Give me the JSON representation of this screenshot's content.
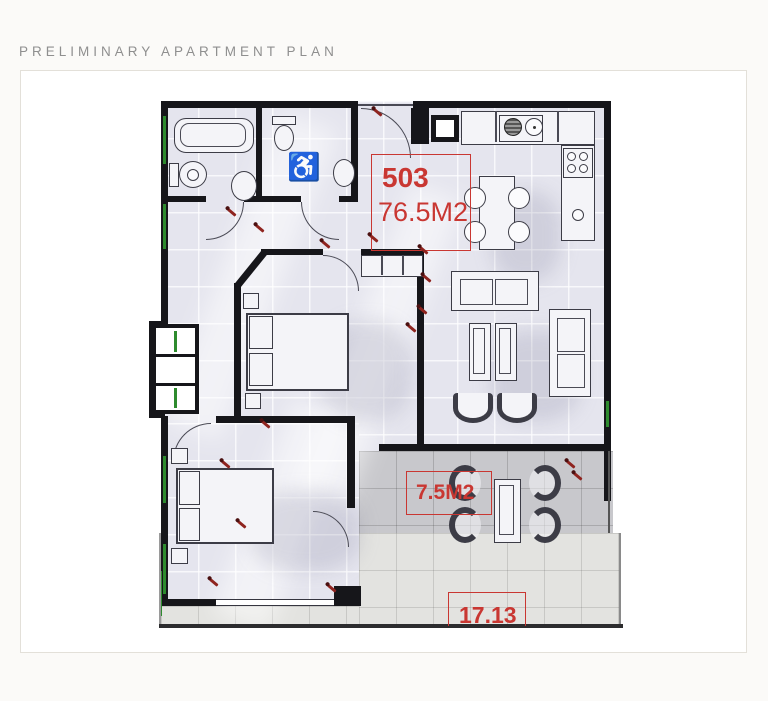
{
  "page": {
    "title": "PRELIMINARY APARTMENT PLAN"
  },
  "plan": {
    "unit": {
      "number": "503",
      "area": "76.5M2"
    },
    "balcony": {
      "area": "7.5M2"
    },
    "terrace": {
      "length": "17.13"
    },
    "accessible_symbol": "♿",
    "colors": {
      "label_red": "#c93732",
      "wall_black": "#16161a",
      "floor_lavender": "#e5e5ee",
      "balcony_gray": "#c8c8cc",
      "terrace_gray": "#e3e3e0",
      "window_green": "#2e8b2e"
    }
  }
}
